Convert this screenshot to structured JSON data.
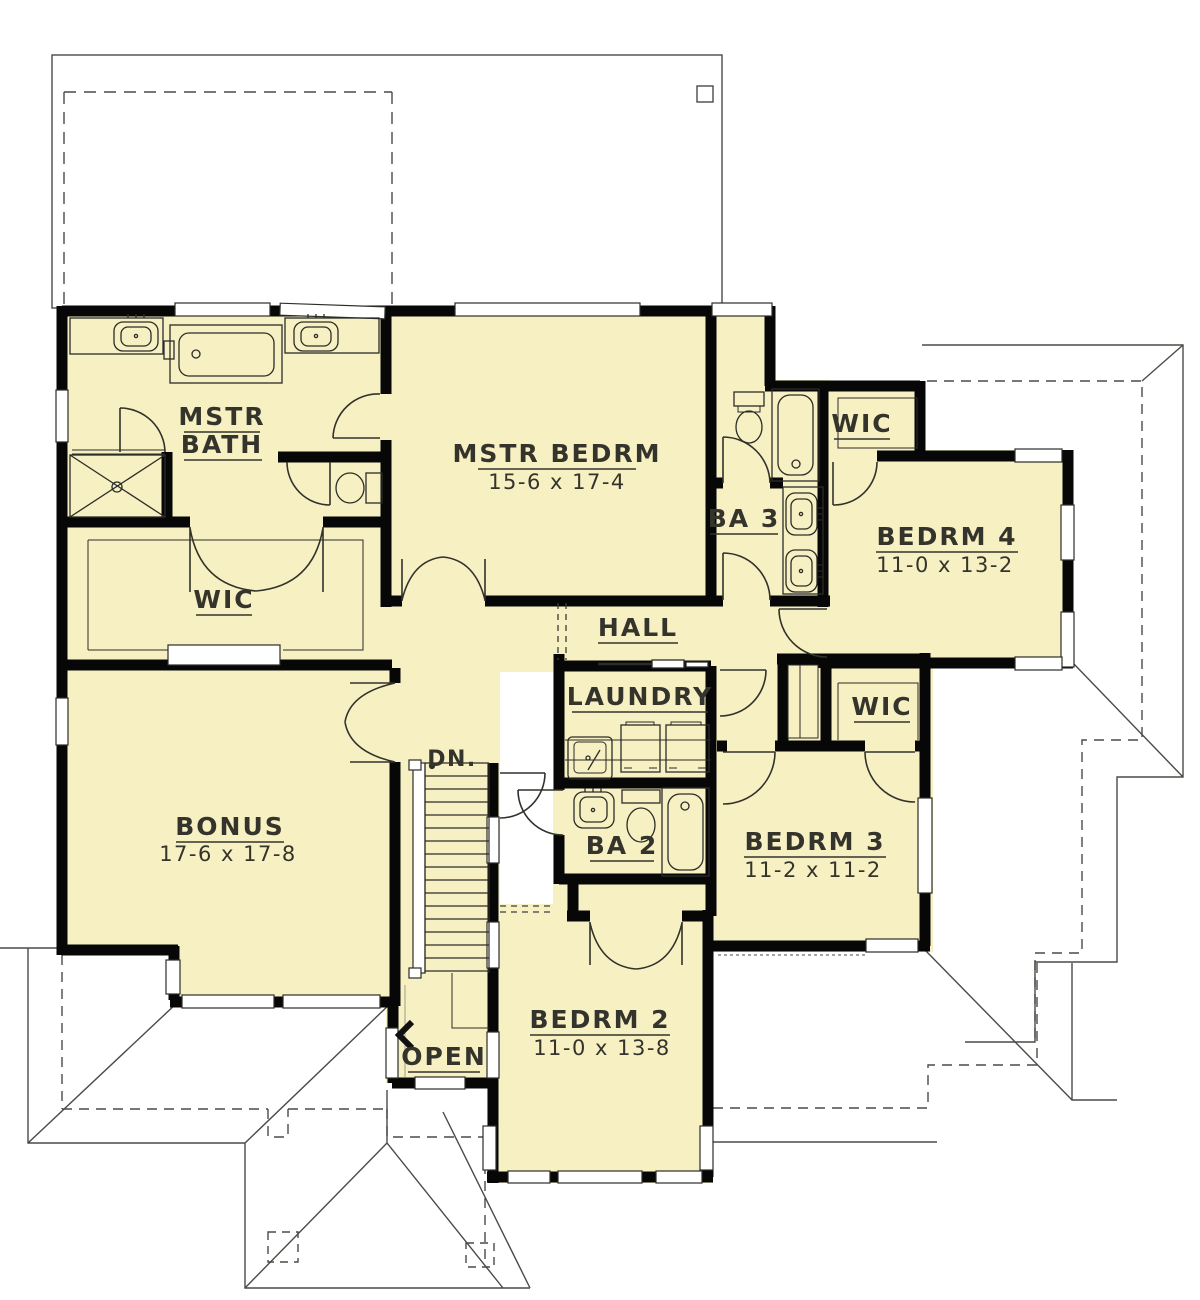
{
  "plan": {
    "colors": {
      "floor": "#F6F0C2",
      "wall": "#070707",
      "line": "#3c3c36",
      "roof": "#4a4a46",
      "text": "#34342c"
    },
    "rooms": [
      {
        "id": "mstr-bath",
        "name_line1": "MSTR",
        "name_line2": "BATH",
        "dims": ""
      },
      {
        "id": "mstr-bedrm",
        "name": "MSTR BEDRM",
        "dims": "15-6 x 17-4"
      },
      {
        "id": "wic-master",
        "name": "WIC",
        "dims": ""
      },
      {
        "id": "ba3",
        "name": "BA 3",
        "dims": ""
      },
      {
        "id": "wic-bedrm4",
        "name": "WIC",
        "dims": ""
      },
      {
        "id": "bedrm4",
        "name": "BEDRM 4",
        "dims": "11-0 x 13-2"
      },
      {
        "id": "hall",
        "name": "HALL",
        "dims": ""
      },
      {
        "id": "laundry",
        "name": "LAUNDRY",
        "dims": ""
      },
      {
        "id": "wic-bedrm3",
        "name": "WIC",
        "dims": ""
      },
      {
        "id": "bedrm3",
        "name": "BEDRM 3",
        "dims": "11-2 x 11-2"
      },
      {
        "id": "bonus",
        "name": "BONUS",
        "dims": "17-6 x 17-8"
      },
      {
        "id": "ba2",
        "name": "BA 2",
        "dims": ""
      },
      {
        "id": "open",
        "name": "OPEN",
        "dims": ""
      },
      {
        "id": "bedrm2",
        "name": "BEDRM 2",
        "dims": "11-0 x 13-8"
      }
    ],
    "stairs": {
      "down_label": "DN."
    }
  }
}
